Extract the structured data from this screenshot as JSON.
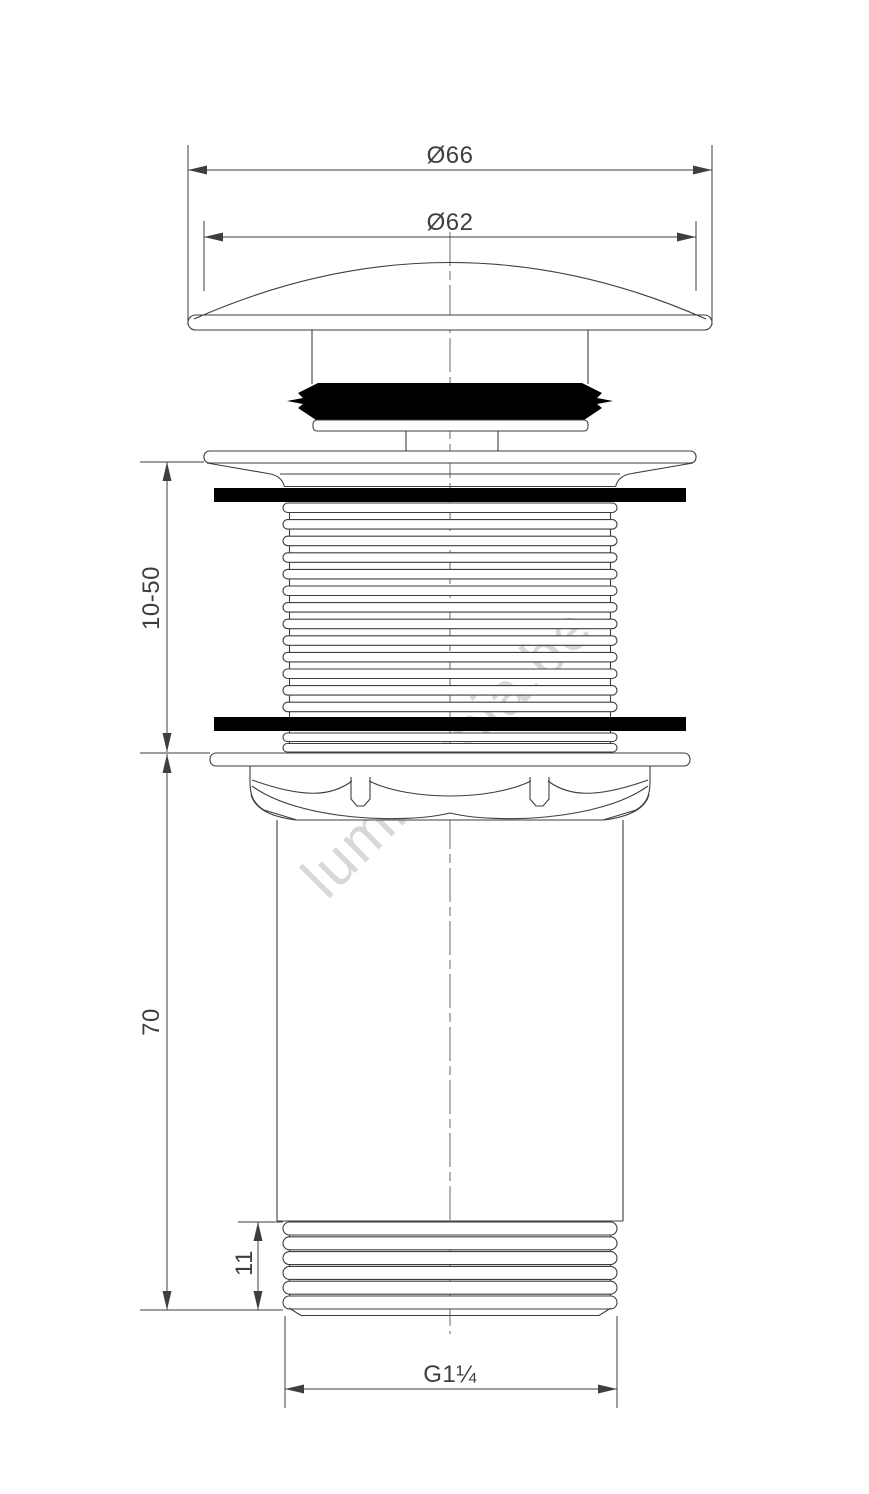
{
  "watermark": {
    "text": "lumimania.be"
  },
  "dimensions": {
    "cap_outer_diameter": {
      "label": "Ø66"
    },
    "cap_inner_diameter": {
      "label": "Ø62"
    },
    "clamp_range": {
      "label": "10-50"
    },
    "body_length": {
      "label": "70"
    },
    "lower_thread_length": {
      "label": "11"
    },
    "thread_size": {
      "label": "G1¼"
    }
  },
  "colors": {
    "line": "#3e3e3e",
    "black_fill": "#000000",
    "watermark": "#d8d8d8",
    "background": "#ffffff"
  }
}
